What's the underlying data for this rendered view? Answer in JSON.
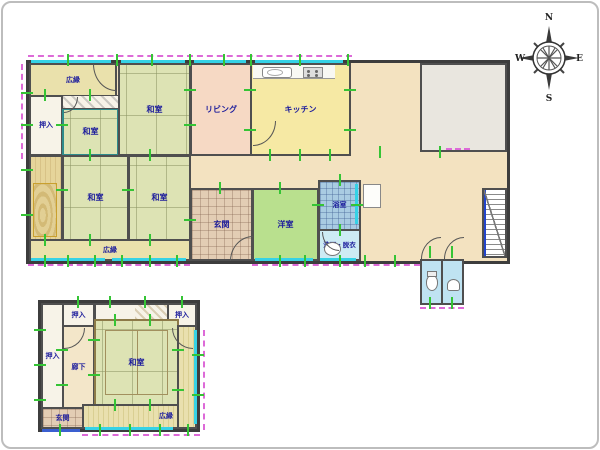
{
  "title": "floor-plan",
  "compass": {
    "n": "N",
    "e": "E",
    "s": "S",
    "w": "W"
  },
  "floor1": {
    "veranda_top": {
      "label": "広縁"
    },
    "oshiire_nw": {
      "label": "押入"
    },
    "washitsu_alcove": {
      "label": "和室"
    },
    "washitsu_n": {
      "label": "和室"
    },
    "living": {
      "label": "リビング"
    },
    "kitchen": {
      "label": "キッチン"
    },
    "washitsu_w": {
      "label": "和室"
    },
    "washitsu_c": {
      "label": "和室"
    },
    "veranda_s": {
      "label": "広縁"
    },
    "genkan": {
      "label": "玄関"
    },
    "youshitsu": {
      "label": "洋室"
    },
    "bathroom": {
      "label": "浴室"
    },
    "washroom": {
      "label": "洗面・脱衣"
    }
  },
  "annex": {
    "oshiire_w": {
      "label": "押入"
    },
    "oshiire_nw": {
      "label": "押入"
    },
    "oshiire_ne": {
      "label": "押入"
    },
    "rouka": {
      "label": "廊下"
    },
    "washitsu": {
      "label": "和室"
    },
    "genkan": {
      "label": "玄関"
    },
    "veranda": {
      "label": "広縁"
    }
  },
  "colors": {
    "tatami": "#dde3b4",
    "living": "#f6d9c4",
    "kitchen": "#f6e9a4",
    "western_room": "#b9e08e",
    "bathroom": "#a9cbe2",
    "washroom": "#cdebf4",
    "toilet": "#bfe3f2",
    "veranda": "#eae1ac",
    "hallway": "#f3e2c0",
    "closet": "#f7f3e8",
    "entrance_tile": "#e3cdb4",
    "gray_room": "#e9e6df",
    "wall": "#4a4a4a",
    "window_glass": "#35d2e6",
    "opening_dashed": "#dd6ad8",
    "module_tick": "#35c435",
    "label_text": "#1c1c9c"
  }
}
